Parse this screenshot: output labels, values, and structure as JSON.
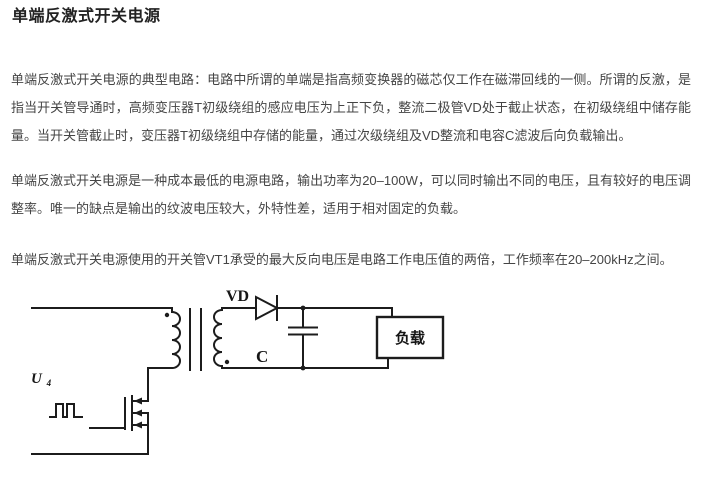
{
  "page": {
    "background": "#ffffff",
    "title_color": "#222222",
    "body_text_color": "#454545",
    "circuit_stroke_color": "#1c1c1c"
  },
  "article": {
    "title": "单端反激式开关电源",
    "paragraphs": [
      "单端反激式开关电源的典型电路：电路中所谓的单端是指高频变换器的磁芯仅工作在磁滞回线的一侧。所谓的反激，是指当开关管导通时，高频变压器T初级绕组的感应电压为上正下负，整流二极管VD处于截止状态，在初级绕组中储存能量。当开关管截止时，变压器T初级绕组中存储的能量，通过次级绕组及VD整流和电容C滤波后向负载输出。",
      "单端反激式开关电源是一种成本最低的电源电路，输出功率为20–100W，可以同时输出不同的电压，且有较好的电压调整率。唯一的缺点是输出的纹波电压较大，外特性差，适用于相对固定的负载。",
      "单端反激式开关电源使用的开关管VT1承受的最大反向电压是电路工作电压值的两倍，工作频率在20–200kHz之间。"
    ]
  },
  "circuit": {
    "labels": {
      "diode": "VD",
      "capacitor": "C",
      "load": "负载",
      "input_voltage": "U",
      "input_voltage_sub": "4"
    }
  }
}
